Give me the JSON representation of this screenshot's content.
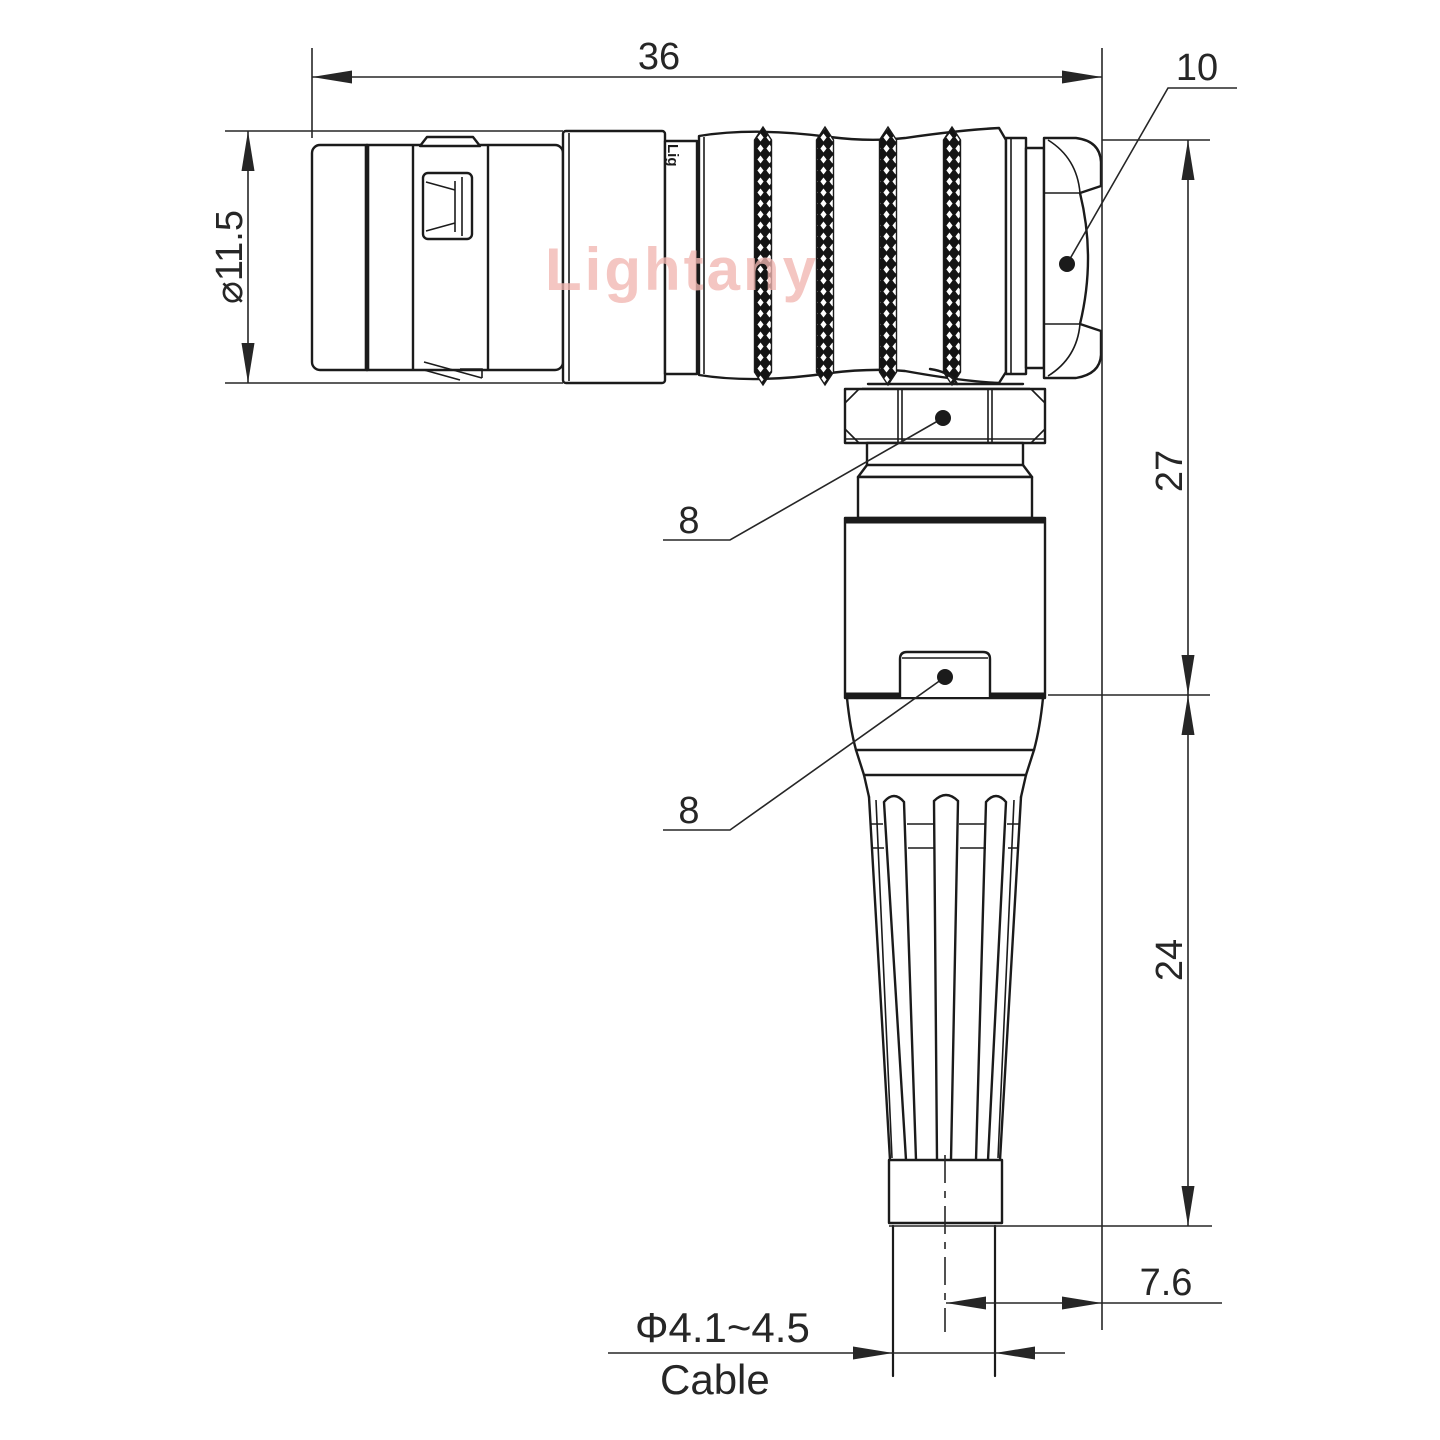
{
  "watermark": {
    "text": "Lightany"
  },
  "shell_marking": "Lig",
  "dims": {
    "overall_length": "36",
    "nut_flat": "10",
    "front_diameter": "⌀11.5",
    "upper_height": "27",
    "hex_callout_top": "8",
    "hex_callout_bottom": "8",
    "lower_height": "24",
    "side_offset": "7.6",
    "cable_diameter": "Φ4.1~4.5",
    "cable_word": "Cable"
  },
  "colors": {
    "line": "#1b1b1b",
    "dim": "#262626",
    "wm": "#f2b7b2"
  }
}
